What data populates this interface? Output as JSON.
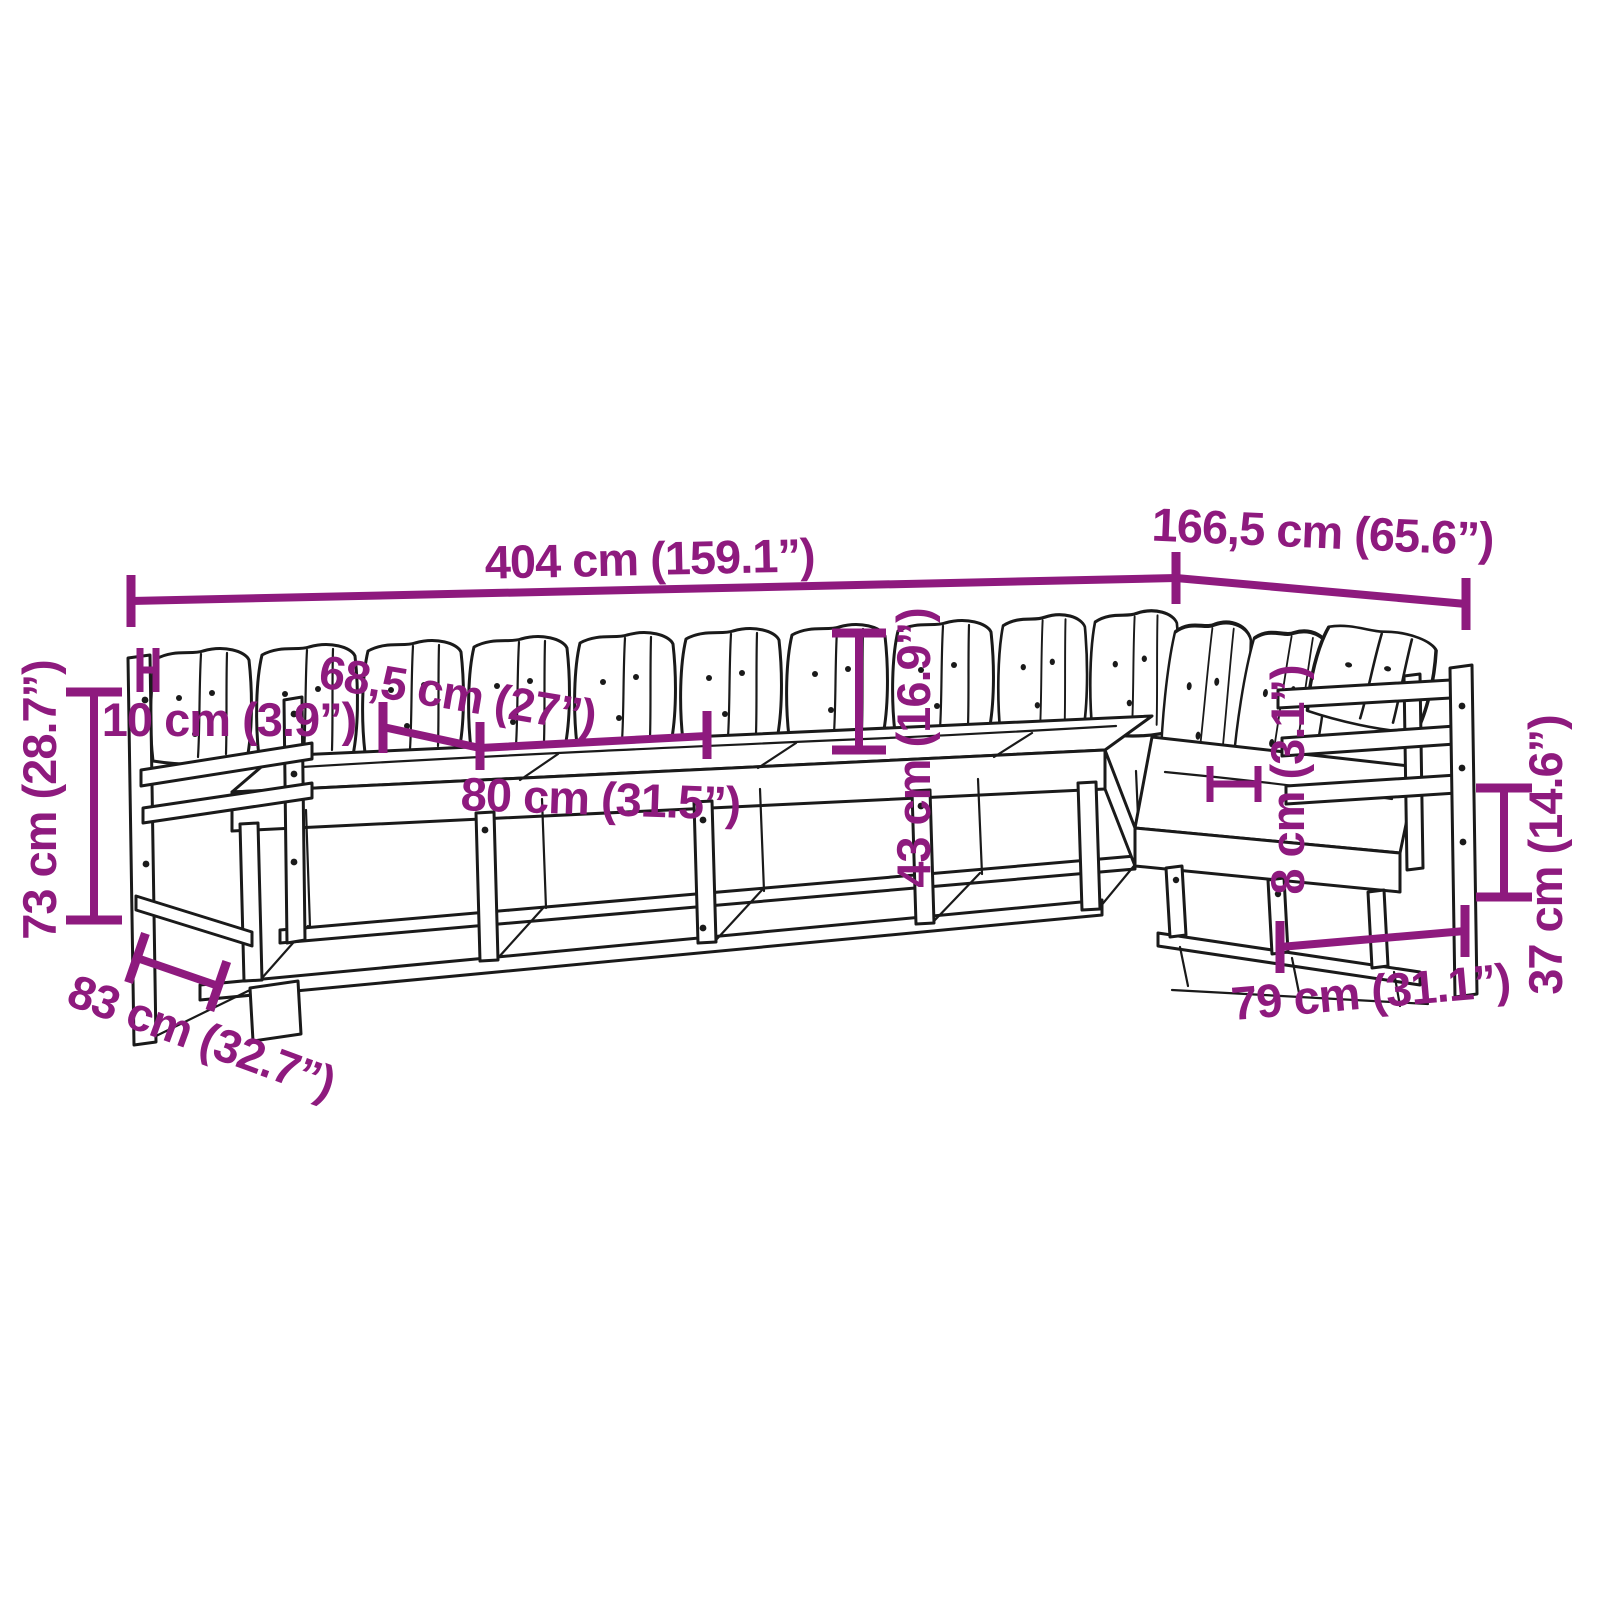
{
  "diagram": {
    "subject": "L-shaped modular garden sofa set with cushions — product dimension line drawing",
    "style": {
      "accent_color": "#8E1A7E",
      "line_color": "#1a1a1a",
      "background": "#ffffff"
    },
    "dimensions": {
      "total_length": "404 cm (159.1”)",
      "return_length": "166,5 cm (65.6”)",
      "overall_height": "73 cm (28.7”)",
      "cushion_thickness": "10 cm (3.9”)",
      "seat_depth": "68,5 cm (27”)",
      "seat_width": "80 cm (31.5”)",
      "backrest_height": "43 cm (16.9”)",
      "frame_thickness": "8 cm (3.1”)",
      "underseat_clearance": "37 cm (14.6”)",
      "end_module_width": "79 cm (31.1”)",
      "module_depth": "83 cm (32.7”)"
    }
  }
}
